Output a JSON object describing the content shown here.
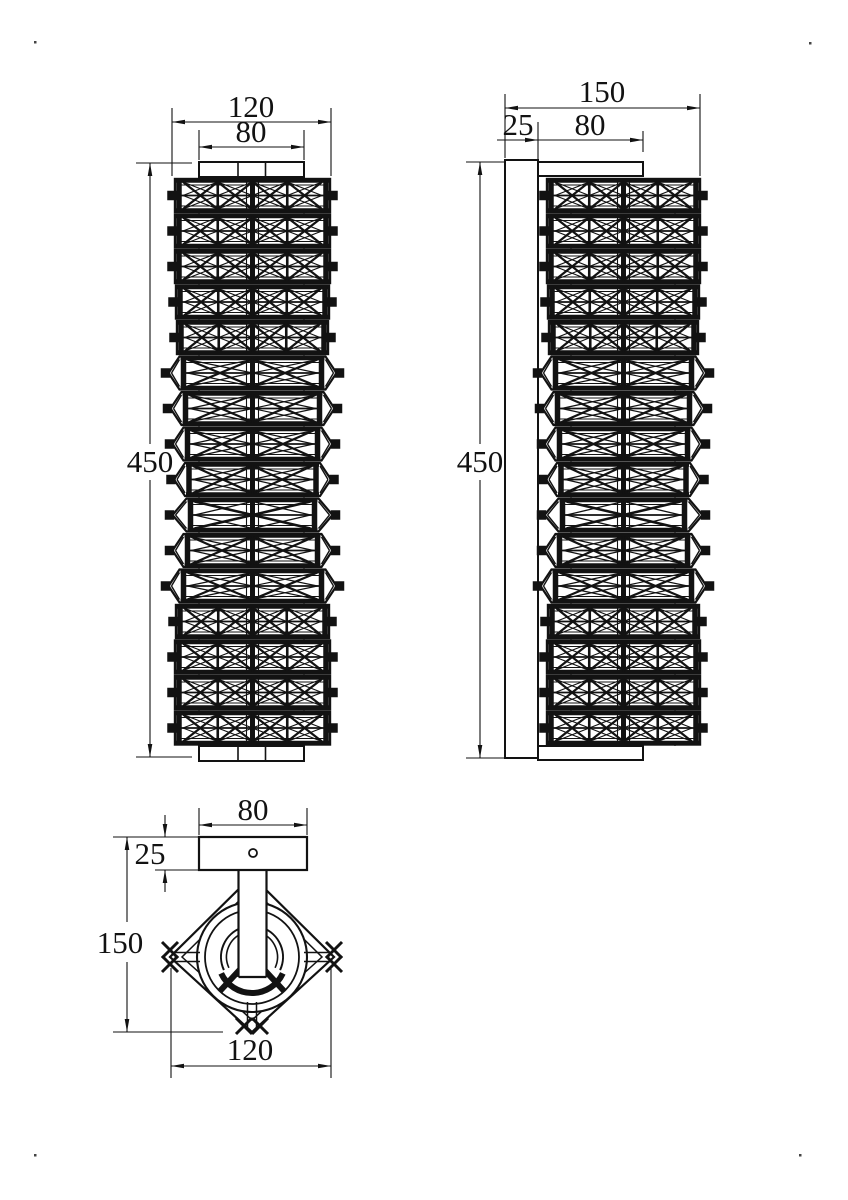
{
  "drawing": {
    "kind": "technical-dimension-drawing",
    "subject": "crystal wall sconce - three orthographic views",
    "ink_color": "#121212",
    "background_color": "#ffffff",
    "views": {
      "front": {
        "label": "front elevation",
        "dimensions": {
          "overall_width": "120",
          "plate_width": "80",
          "overall_height": "450"
        }
      },
      "side": {
        "label": "side elevation",
        "dimensions": {
          "overall_depth": "150",
          "backplate_depth": "25",
          "bracket_depth": "80",
          "overall_height": "450"
        }
      },
      "plan": {
        "label": "bottom plan view",
        "dimensions": {
          "plate_width": "80",
          "plate_depth": "25",
          "overall_projection": "150",
          "overall_width": "120"
        }
      }
    }
  }
}
